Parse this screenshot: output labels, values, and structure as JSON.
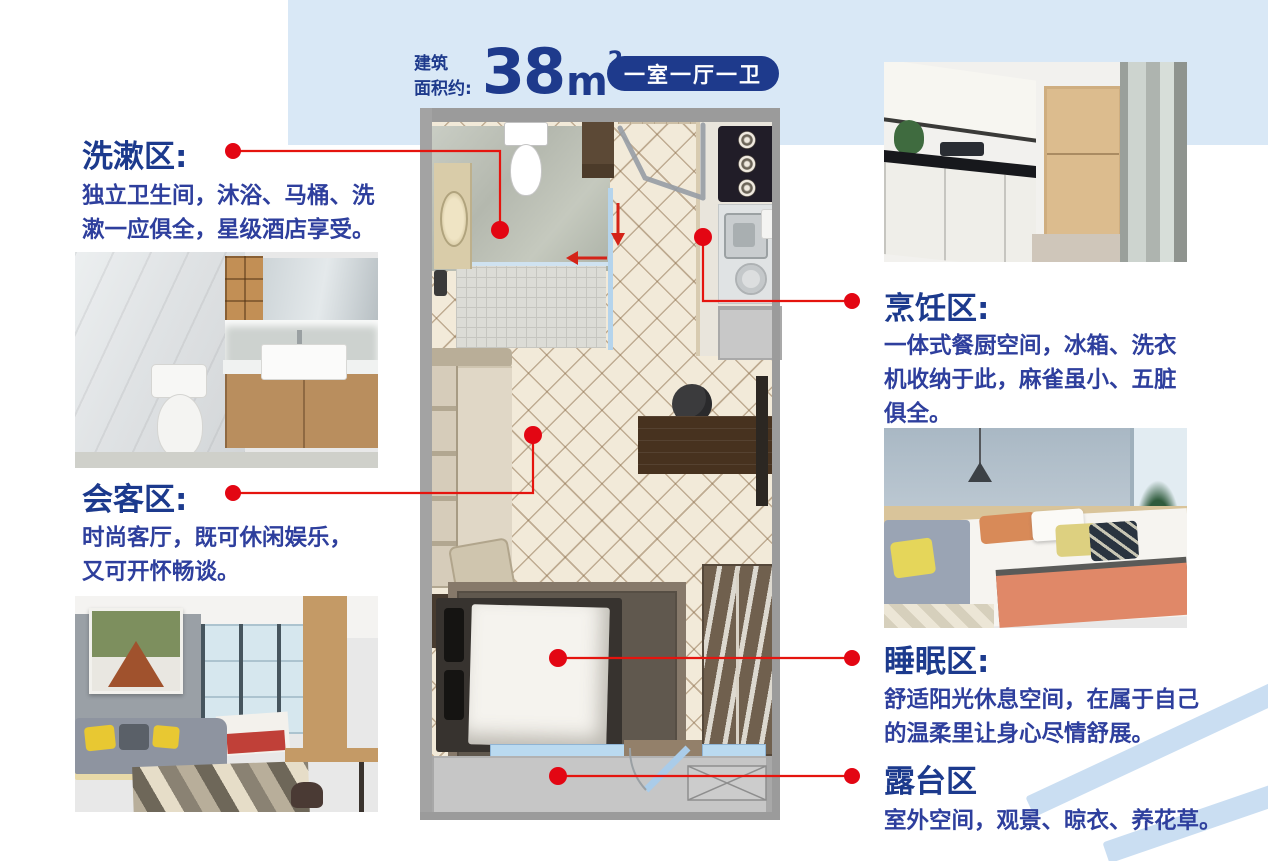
{
  "header": {
    "area_prefix_line1": "建筑",
    "area_prefix_line2": "面积约:",
    "area_value": "38",
    "area_unit": "m",
    "area_sup": "2",
    "layout_badge": "一室一厅一卫"
  },
  "callouts": {
    "washing": {
      "title": "洗漱区:",
      "desc": "独立卫生间，沐浴、马桶、洗漱一应俱全，星级酒店享受。"
    },
    "living": {
      "title": "会客区:",
      "desc": "时尚客厅，既可休闲娱乐，又可开怀畅谈。"
    },
    "cooking": {
      "title": "烹饪区:",
      "desc": "一体式餐厨空间，冰箱、洗衣机收纳于此，麻雀虽小、五脏俱全。"
    },
    "sleeping": {
      "title": "睡眠区:",
      "desc": "舒适阳光休息空间，在属于自己的温柔里让身心尽情舒展。"
    },
    "terrace": {
      "title": "露台区",
      "desc": "室外空间，观景、晾衣、养花草。"
    }
  },
  "colors": {
    "primary_blue": "#1e3a8c",
    "body_blue": "#2e3f9d",
    "panel_blue": "#d9e8f6",
    "callout_red": "#e5140e",
    "stripe_blue": "#cadef2"
  }
}
